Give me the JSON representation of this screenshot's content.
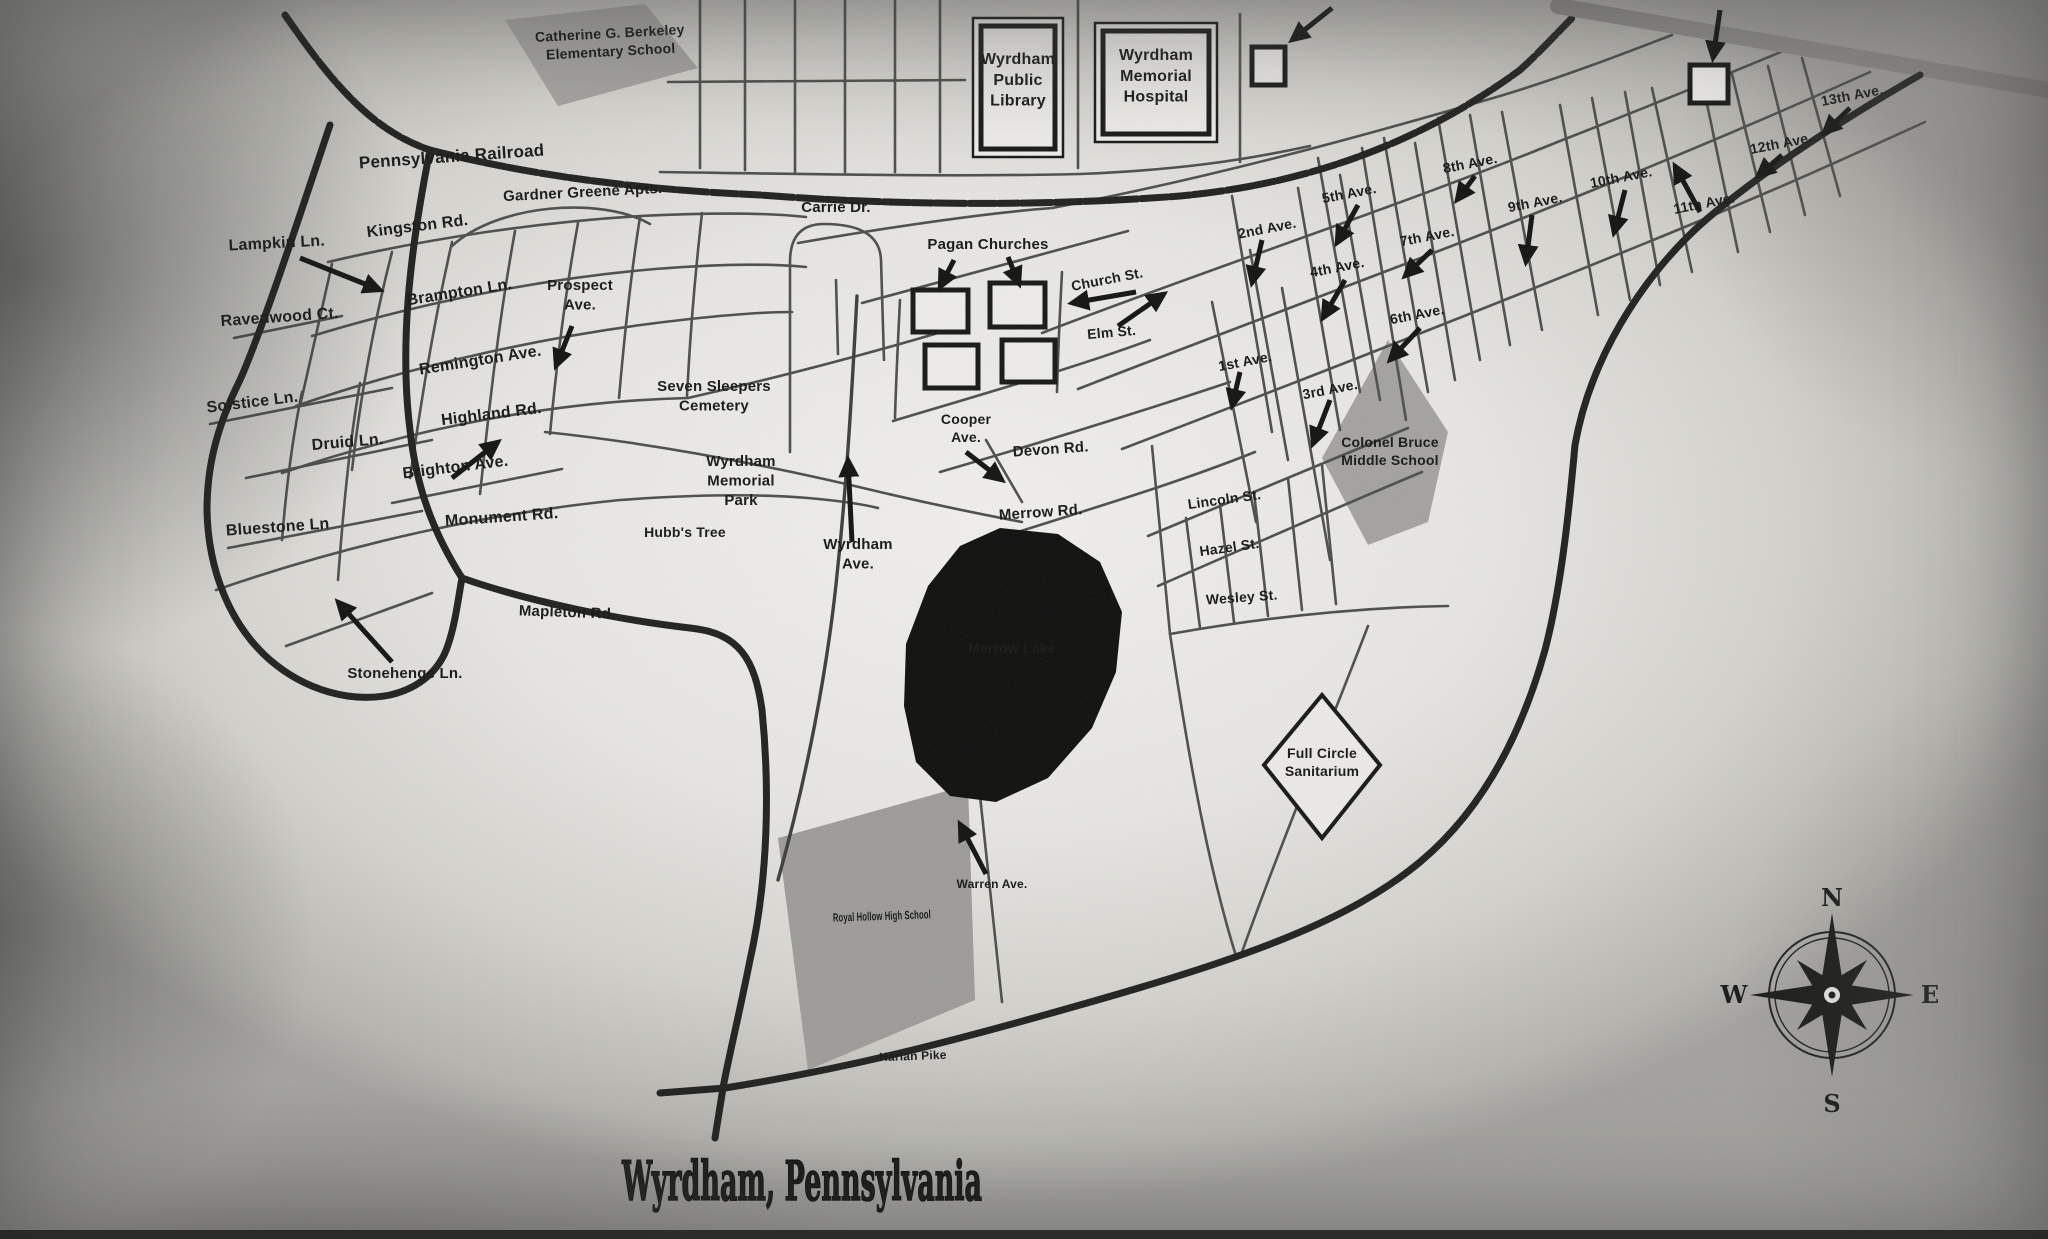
{
  "title": "Wyrdham, Pennsylvania",
  "compass": {
    "n": "N",
    "e": "E",
    "s": "S",
    "w": "W"
  },
  "map": {
    "labels": [
      {
        "id": "catherine-berkeley-school",
        "lines": [
          "Catherine G. Berkeley",
          "Elementary School"
        ],
        "x": 610,
        "y": 38,
        "s": 14,
        "r": -3
      },
      {
        "id": "wyrdham-public-library",
        "lines": [
          "Wyrdham",
          "Public",
          "Library"
        ],
        "x": 1018,
        "y": 64,
        "s": 16,
        "r": 0
      },
      {
        "id": "wyrdham-memorial-hospital",
        "lines": [
          "Wyrdham",
          "Memorial",
          "Hospital"
        ],
        "x": 1156,
        "y": 60,
        "s": 16,
        "r": 0
      },
      {
        "id": "pennsylvania-railroad",
        "lines": [
          "Pennsylvania Railroad"
        ],
        "x": 452,
        "y": 162,
        "s": 17,
        "r": -4
      },
      {
        "id": "gardner-greene-apts",
        "lines": [
          "Gardner Greene Apts."
        ],
        "x": 583,
        "y": 197,
        "s": 15,
        "r": -3
      },
      {
        "id": "carrie-dr",
        "lines": [
          "Carrie Dr."
        ],
        "x": 836,
        "y": 212,
        "s": 15,
        "r": 0
      },
      {
        "id": "lampkin-ln",
        "lines": [
          "Lampkin Ln."
        ],
        "x": 277,
        "y": 248,
        "s": 16,
        "r": -3
      },
      {
        "id": "kingston-rd",
        "lines": [
          "Kingston Rd."
        ],
        "x": 418,
        "y": 231,
        "s": 16,
        "r": -7
      },
      {
        "id": "brampton-ln",
        "lines": [
          "Brampton Ln."
        ],
        "x": 460,
        "y": 297,
        "s": 16,
        "r": -9
      },
      {
        "id": "prospect-ave",
        "lines": [
          "Prospect",
          "Ave."
        ],
        "x": 580,
        "y": 290,
        "s": 15,
        "r": 0
      },
      {
        "id": "ravenwood-ct",
        "lines": [
          "Ravenwood Ct."
        ],
        "x": 280,
        "y": 322,
        "s": 16,
        "r": -4
      },
      {
        "id": "remington-ave",
        "lines": [
          "Remington Ave."
        ],
        "x": 481,
        "y": 365,
        "s": 16,
        "r": -9
      },
      {
        "id": "solstice-ln",
        "lines": [
          "Solstice Ln."
        ],
        "x": 253,
        "y": 407,
        "s": 16,
        "r": -7
      },
      {
        "id": "druid-ln",
        "lines": [
          "Druid Ln."
        ],
        "x": 348,
        "y": 447,
        "s": 16,
        "r": -5
      },
      {
        "id": "highland-rd",
        "lines": [
          "Highland Rd."
        ],
        "x": 492,
        "y": 419,
        "s": 16,
        "r": -7
      },
      {
        "id": "brighton-ave",
        "lines": [
          "Brighton Ave."
        ],
        "x": 456,
        "y": 472,
        "s": 16,
        "r": -7
      },
      {
        "id": "bluestone-ln",
        "lines": [
          "Bluestone Ln"
        ],
        "x": 278,
        "y": 532,
        "s": 16,
        "r": -4
      },
      {
        "id": "monument-rd",
        "lines": [
          "Monument Rd."
        ],
        "x": 502,
        "y": 522,
        "s": 16,
        "r": -4
      },
      {
        "id": "mapleton-rd",
        "lines": [
          "Mapleton Rd."
        ],
        "x": 567,
        "y": 617,
        "s": 15,
        "r": 2
      },
      {
        "id": "stonehenge-ln",
        "lines": [
          "Stonehenge Ln."
        ],
        "x": 405,
        "y": 678,
        "s": 15,
        "r": 0
      },
      {
        "id": "seven-sleepers-cemetery",
        "lines": [
          "Seven Sleepers",
          "Cemetery"
        ],
        "x": 714,
        "y": 391,
        "s": 15,
        "r": 0
      },
      {
        "id": "wyrdham-memorial-park",
        "lines": [
          "Wyrdham",
          "Memorial",
          "Park"
        ],
        "x": 741,
        "y": 466,
        "s": 15,
        "r": 0
      },
      {
        "id": "hubbs-tree",
        "lines": [
          "Hubb's Tree"
        ],
        "x": 685,
        "y": 537,
        "s": 14,
        "r": 0
      },
      {
        "id": "wyrdham-ave",
        "lines": [
          "Wyrdham",
          "Ave."
        ],
        "x": 858,
        "y": 549,
        "s": 15,
        "r": 0
      },
      {
        "id": "pagan-churches",
        "lines": [
          "Pagan Churches"
        ],
        "x": 988,
        "y": 249,
        "s": 15,
        "r": 0
      },
      {
        "id": "church-st",
        "lines": [
          "Church St."
        ],
        "x": 1108,
        "y": 284,
        "s": 14,
        "r": -11
      },
      {
        "id": "elm-st",
        "lines": [
          "Elm St."
        ],
        "x": 1112,
        "y": 337,
        "s": 14,
        "r": -5
      },
      {
        "id": "cooper-ave",
        "lines": [
          "Cooper",
          "Ave."
        ],
        "x": 966,
        "y": 424,
        "s": 14,
        "r": 0
      },
      {
        "id": "devon-rd",
        "lines": [
          "Devon Rd."
        ],
        "x": 1051,
        "y": 454,
        "s": 15,
        "r": -4
      },
      {
        "id": "merrow-rd",
        "lines": [
          "Merrow Rd."
        ],
        "x": 1041,
        "y": 517,
        "s": 15,
        "r": -4
      },
      {
        "id": "first-ave",
        "lines": [
          "1st Ave."
        ],
        "x": 1246,
        "y": 366,
        "s": 14,
        "r": -11
      },
      {
        "id": "second-ave",
        "lines": [
          "2nd Ave."
        ],
        "x": 1268,
        "y": 233,
        "s": 14,
        "r": -11
      },
      {
        "id": "third-ave",
        "lines": [
          "3rd Ave."
        ],
        "x": 1331,
        "y": 394,
        "s": 14,
        "r": -11
      },
      {
        "id": "fourth-ave",
        "lines": [
          "4th Ave."
        ],
        "x": 1338,
        "y": 272,
        "s": 14,
        "r": -11
      },
      {
        "id": "fifth-ave",
        "lines": [
          "5th Ave."
        ],
        "x": 1350,
        "y": 198,
        "s": 14,
        "r": -11
      },
      {
        "id": "sixth-ave",
        "lines": [
          "6th Ave."
        ],
        "x": 1418,
        "y": 319,
        "s": 14,
        "r": -11
      },
      {
        "id": "seventh-ave",
        "lines": [
          "7th Ave."
        ],
        "x": 1428,
        "y": 241,
        "s": 14,
        "r": -11
      },
      {
        "id": "eighth-ave",
        "lines": [
          "8th Ave."
        ],
        "x": 1471,
        "y": 168,
        "s": 14,
        "r": -11
      },
      {
        "id": "ninth-ave",
        "lines": [
          "9th Ave."
        ],
        "x": 1536,
        "y": 207,
        "s": 14,
        "r": -11
      },
      {
        "id": "tenth-ave",
        "lines": [
          "10th Ave."
        ],
        "x": 1622,
        "y": 182,
        "s": 14,
        "r": -11
      },
      {
        "id": "eleventh-ave",
        "lines": [
          "11th Ave."
        ],
        "x": 1705,
        "y": 208,
        "s": 14,
        "r": -11
      },
      {
        "id": "twelfth-ave",
        "lines": [
          "12th Ave."
        ],
        "x": 1782,
        "y": 148,
        "s": 14,
        "r": -11
      },
      {
        "id": "thirteenth-ave",
        "lines": [
          "13th Ave."
        ],
        "x": 1853,
        "y": 100,
        "s": 14,
        "r": -11
      },
      {
        "id": "lincoln-st",
        "lines": [
          "Lincoln St."
        ],
        "x": 1225,
        "y": 504,
        "s": 14,
        "r": -8
      },
      {
        "id": "hazel-st",
        "lines": [
          "Hazel St."
        ],
        "x": 1230,
        "y": 552,
        "s": 14,
        "r": -8
      },
      {
        "id": "wesley-st",
        "lines": [
          "Wesley St."
        ],
        "x": 1242,
        "y": 602,
        "s": 14,
        "r": -4
      },
      {
        "id": "colonel-bruce-middle-school",
        "lines": [
          "Colonel Bruce",
          "Middle School"
        ],
        "x": 1390,
        "y": 447,
        "s": 14,
        "r": 0
      },
      {
        "id": "merrow-lake",
        "lines": [
          "Merrow Lake"
        ],
        "x": 1012,
        "y": 653,
        "s": 14,
        "r": 0,
        "c": "#e9e8e4"
      },
      {
        "id": "full-circle-sanitarium",
        "lines": [
          "Full Circle",
          "Sanitarium"
        ],
        "x": 1322,
        "y": 758,
        "s": 14,
        "r": 0
      },
      {
        "id": "royal-hollow-high-school",
        "lines": [
          "Royal Hollow High School"
        ],
        "x": 882,
        "y": 920,
        "s": 12,
        "r": -2,
        "tl": 98
      },
      {
        "id": "warren-ave",
        "lines": [
          "Warren Ave."
        ],
        "x": 992,
        "y": 888,
        "s": 12,
        "r": 0
      },
      {
        "id": "harlan-pike",
        "lines": [
          "Harlan Pike"
        ],
        "x": 913,
        "y": 1060,
        "s": 12,
        "r": -2
      }
    ]
  }
}
